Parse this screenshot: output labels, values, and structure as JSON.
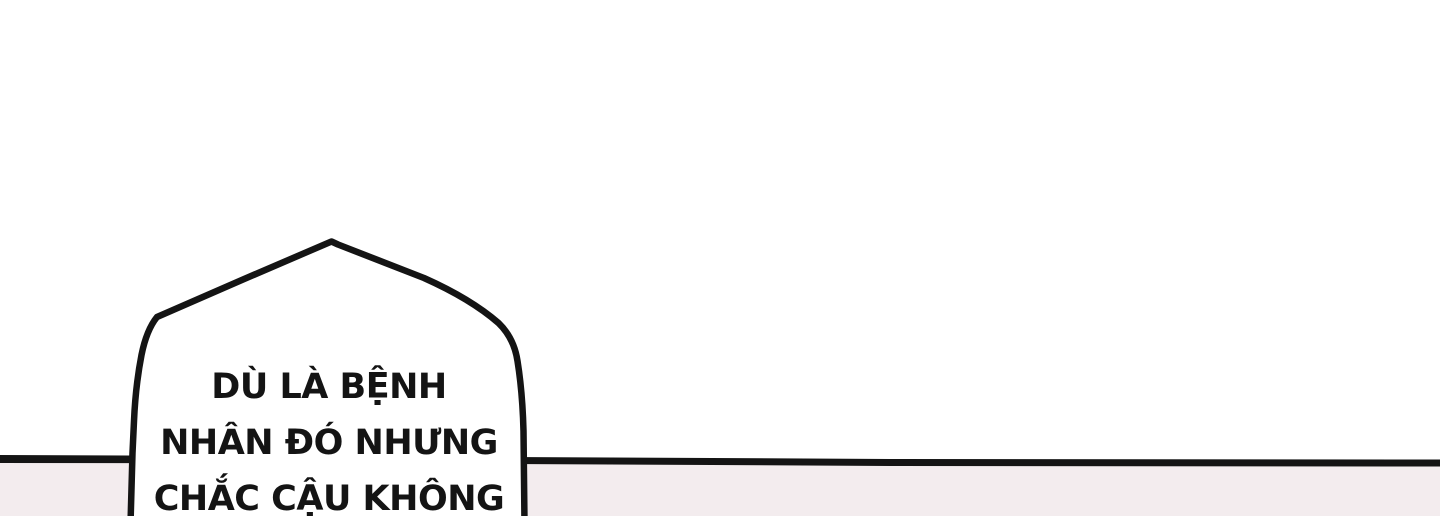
{
  "page": {
    "background_color": "#ffffff"
  },
  "lower_panel": {
    "background_color": "#f3ecee",
    "divider_color": "#141414"
  },
  "speech_bubble": {
    "fill_color": "#ffffff",
    "stroke_color": "#141414",
    "text_color": "#141414",
    "lines": [
      "DÙ LÀ BỆNH",
      "NHÂN ĐÓ NHƯNG",
      "CHẮC CẬU KHÔNG"
    ]
  }
}
